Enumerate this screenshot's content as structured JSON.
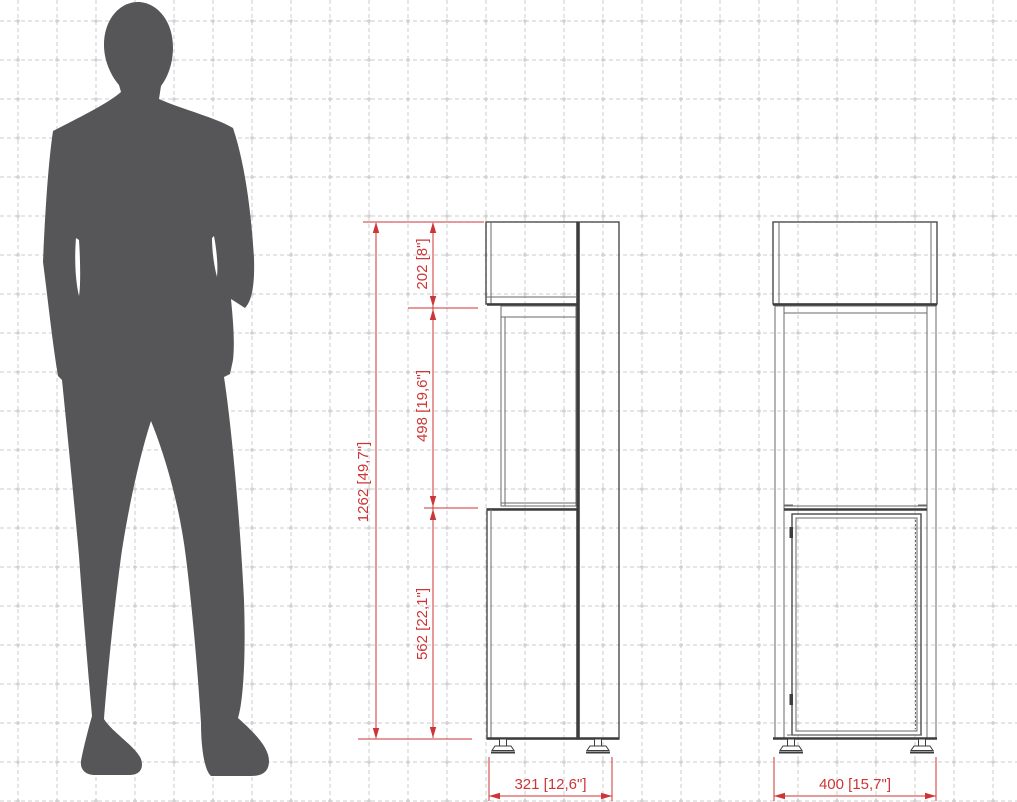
{
  "diagram": {
    "dimensions": {
      "overall_height": "1262 [49,7\"]",
      "top_section_height": "202 [8\"]",
      "middle_section_height": "498 [19,6\"]",
      "bottom_section_height": "562 [22,1\"]",
      "side_depth": "321 [12,6\"]",
      "front_width": "400 [15,7\"]"
    },
    "colors": {
      "dim-red": "#cc3636",
      "silhouette": "#565658",
      "line-dark": "#3d3d3d",
      "line-mid": "#6a6a6a",
      "grid-line": "#dedede",
      "grid-dot": "#d2d2d2",
      "background": "#ffffff"
    }
  }
}
